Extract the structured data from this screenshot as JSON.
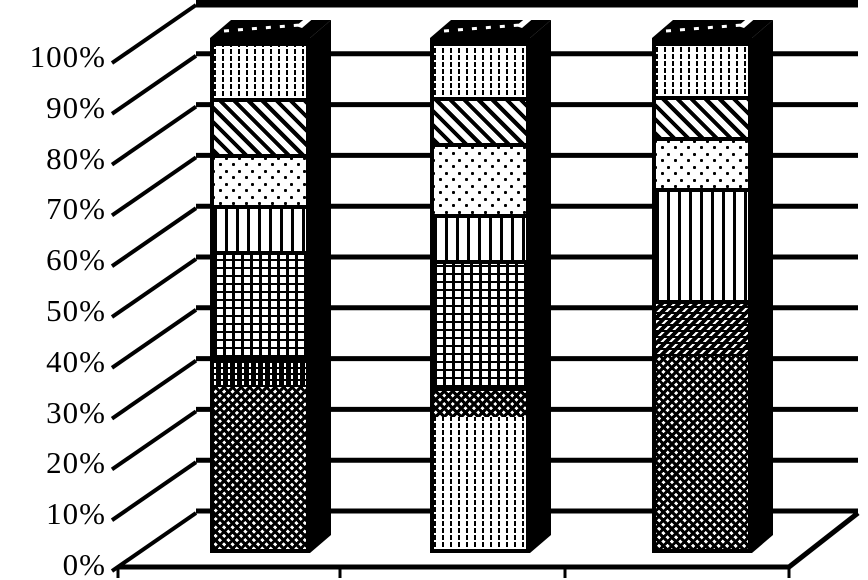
{
  "chart_data": {
    "type": "bar",
    "subtype": "100-percent-stacked-column-3d",
    "style": "monochrome-scanned-pattern-fills",
    "title": "",
    "xlabel": "",
    "ylabel": "",
    "legend": "none",
    "grid": true,
    "ylim": [
      0,
      100
    ],
    "y_ticks": [
      "0%",
      "10%",
      "20%",
      "30%",
      "40%",
      "50%",
      "60%",
      "70%",
      "80%",
      "90%",
      "100%"
    ],
    "categories": [
      "column-1",
      "column-2",
      "column-3"
    ],
    "bars": [
      {
        "category": "column-1",
        "segments_bottom_to_top": [
          {
            "pattern": "dense-crosshatch",
            "value": 32
          },
          {
            "pattern": "dark-vertical-dash",
            "value": 6
          },
          {
            "pattern": "grid",
            "value": 21
          },
          {
            "pattern": "vertical-lines",
            "value": 9
          },
          {
            "pattern": "dots",
            "value": 10
          },
          {
            "pattern": "diagonal-stripes",
            "value": 11
          },
          {
            "pattern": "vertical-dashes",
            "value": 11
          }
        ]
      },
      {
        "category": "column-2",
        "segments_bottom_to_top": [
          {
            "pattern": "vertical-dashes",
            "value": 26
          },
          {
            "pattern": "dense-crosshatch",
            "value": 6
          },
          {
            "pattern": "grid",
            "value": 25
          },
          {
            "pattern": "vertical-lines",
            "value": 9
          },
          {
            "pattern": "dots",
            "value": 14
          },
          {
            "pattern": "diagonal-stripes",
            "value": 9
          },
          {
            "pattern": "vertical-dashes",
            "value": 11
          }
        ]
      },
      {
        "category": "column-3",
        "segments_bottom_to_top": [
          {
            "pattern": "dense-crosshatch",
            "value": 38
          },
          {
            "pattern": "dark-diagonal",
            "value": 11
          },
          {
            "pattern": "vertical-lines",
            "value": 22
          },
          {
            "pattern": "dots",
            "value": 10
          },
          {
            "pattern": "diagonal-stripes",
            "value": 8
          },
          {
            "pattern": "vertical-dashes",
            "value": 11
          }
        ]
      }
    ]
  },
  "colors": {
    "ink": "#000000",
    "paper": "#ffffff"
  }
}
